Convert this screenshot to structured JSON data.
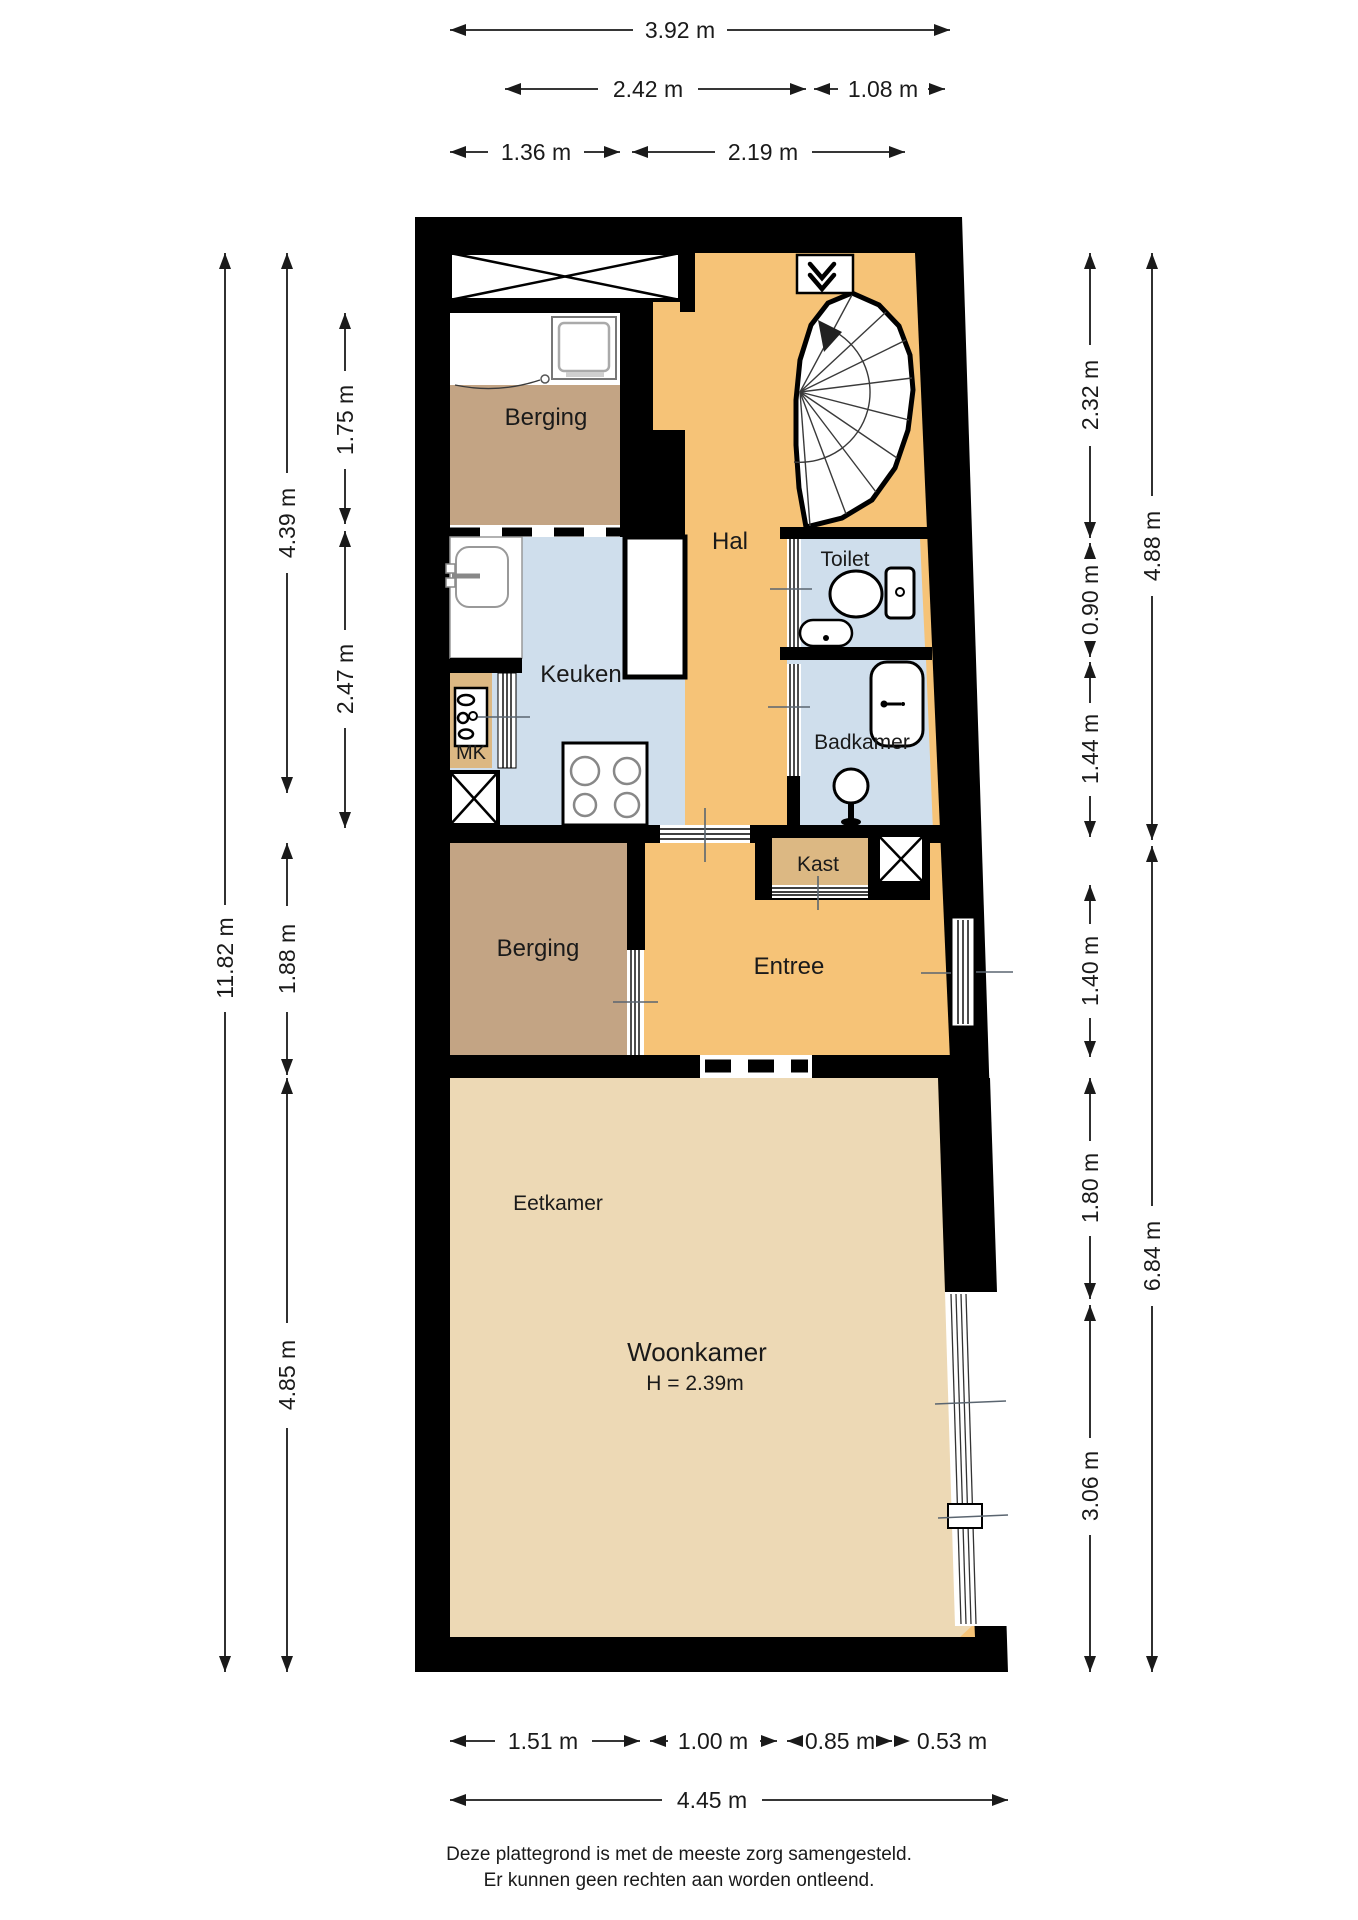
{
  "rooms": {
    "berging_top": "Berging",
    "hal": "Hal",
    "toilet": "Toilet",
    "keuken": "Keuken",
    "mk": "MK",
    "badkamer": "Badkamer",
    "kast": "Kast",
    "berging": "Berging",
    "entree": "Entree",
    "eetkamer": "Eetkamer",
    "woonkamer": "Woonkamer",
    "woonkamer_ceiling_height": "H = 2.39m"
  },
  "dimensions": {
    "top": [
      "3.92 m",
      "2.42 m",
      "1.08 m",
      "1.36 m",
      "2.19 m"
    ],
    "left": [
      "11.82 m",
      "4.39 m",
      "1.75 m",
      "2.47 m",
      "1.88 m",
      "4.85 m"
    ],
    "right": [
      "2.32 m",
      "0.90 m",
      "1.44 m",
      "1.40 m",
      "1.80 m",
      "3.06 m",
      "4.88 m",
      "6.84 m"
    ],
    "bottom": [
      "1.51 m",
      "1.00 m",
      "0.85 m",
      "0.53 m",
      "4.45 m"
    ]
  },
  "footer": {
    "line1": "Deze plattegrond is met de meeste zorg samengesteld.",
    "line2": "Er kunnen geen rechten aan worden ontleend."
  },
  "colors": {
    "wall": "#000000",
    "hal-floor": "#F6C377",
    "wet-floor": "#CFDEEC",
    "berging-floor": "#C3A484",
    "living-floor": "#EDD9B5",
    "closet-floor": "#DCB883",
    "dim": "#1a1a1a"
  }
}
